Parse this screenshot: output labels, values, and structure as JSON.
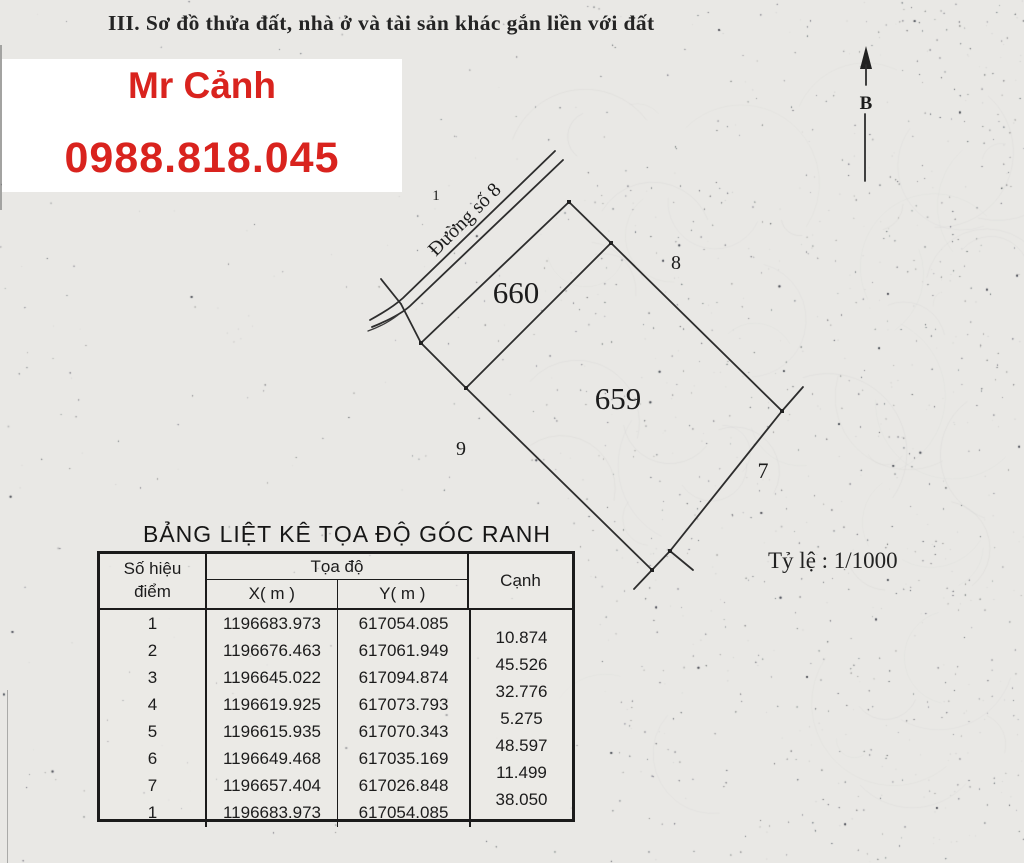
{
  "page": {
    "title": "III. Sơ đồ thửa đất, nhà ở và tài sản khác gắn liền với đất"
  },
  "contact": {
    "name": "Mr Cảnh",
    "phone": "0988.818.045",
    "text_color": "#d9231e"
  },
  "diagram": {
    "scale_label": "Tỷ lệ : 1/1000",
    "north_label": "B",
    "road_label": "Đường số 8",
    "labels": {
      "parcel_660": "660",
      "parcel_659": "659",
      "adj_1": "1",
      "adj_8": "8",
      "adj_9": "9",
      "adj_7": "7"
    }
  },
  "table": {
    "title": "BẢNG LIỆT KÊ TỌA ĐỘ GÓC RANH",
    "headers": {
      "point_line1": "Số hiệu",
      "point_line2": "điểm",
      "coords": "Tọa độ",
      "x": "X( m )",
      "y": "Y( m )",
      "edge": "Cạnh"
    },
    "rows": [
      {
        "point": "1",
        "x": "1196683.973",
        "y": "617054.085"
      },
      {
        "point": "2",
        "x": "1196676.463",
        "y": "617061.949"
      },
      {
        "point": "3",
        "x": "1196645.022",
        "y": "617094.874"
      },
      {
        "point": "4",
        "x": "1196619.925",
        "y": "617073.793"
      },
      {
        "point": "5",
        "x": "1196615.935",
        "y": "617070.343"
      },
      {
        "point": "6",
        "x": "1196649.468",
        "y": "617035.169"
      },
      {
        "point": "7",
        "x": "1196657.404",
        "y": "617026.848"
      },
      {
        "point": "1",
        "x": "1196683.973",
        "y": "617054.085"
      }
    ],
    "edges": [
      "10.874",
      "45.526",
      "32.776",
      "5.275",
      "48.597",
      "11.499",
      "38.050"
    ]
  }
}
